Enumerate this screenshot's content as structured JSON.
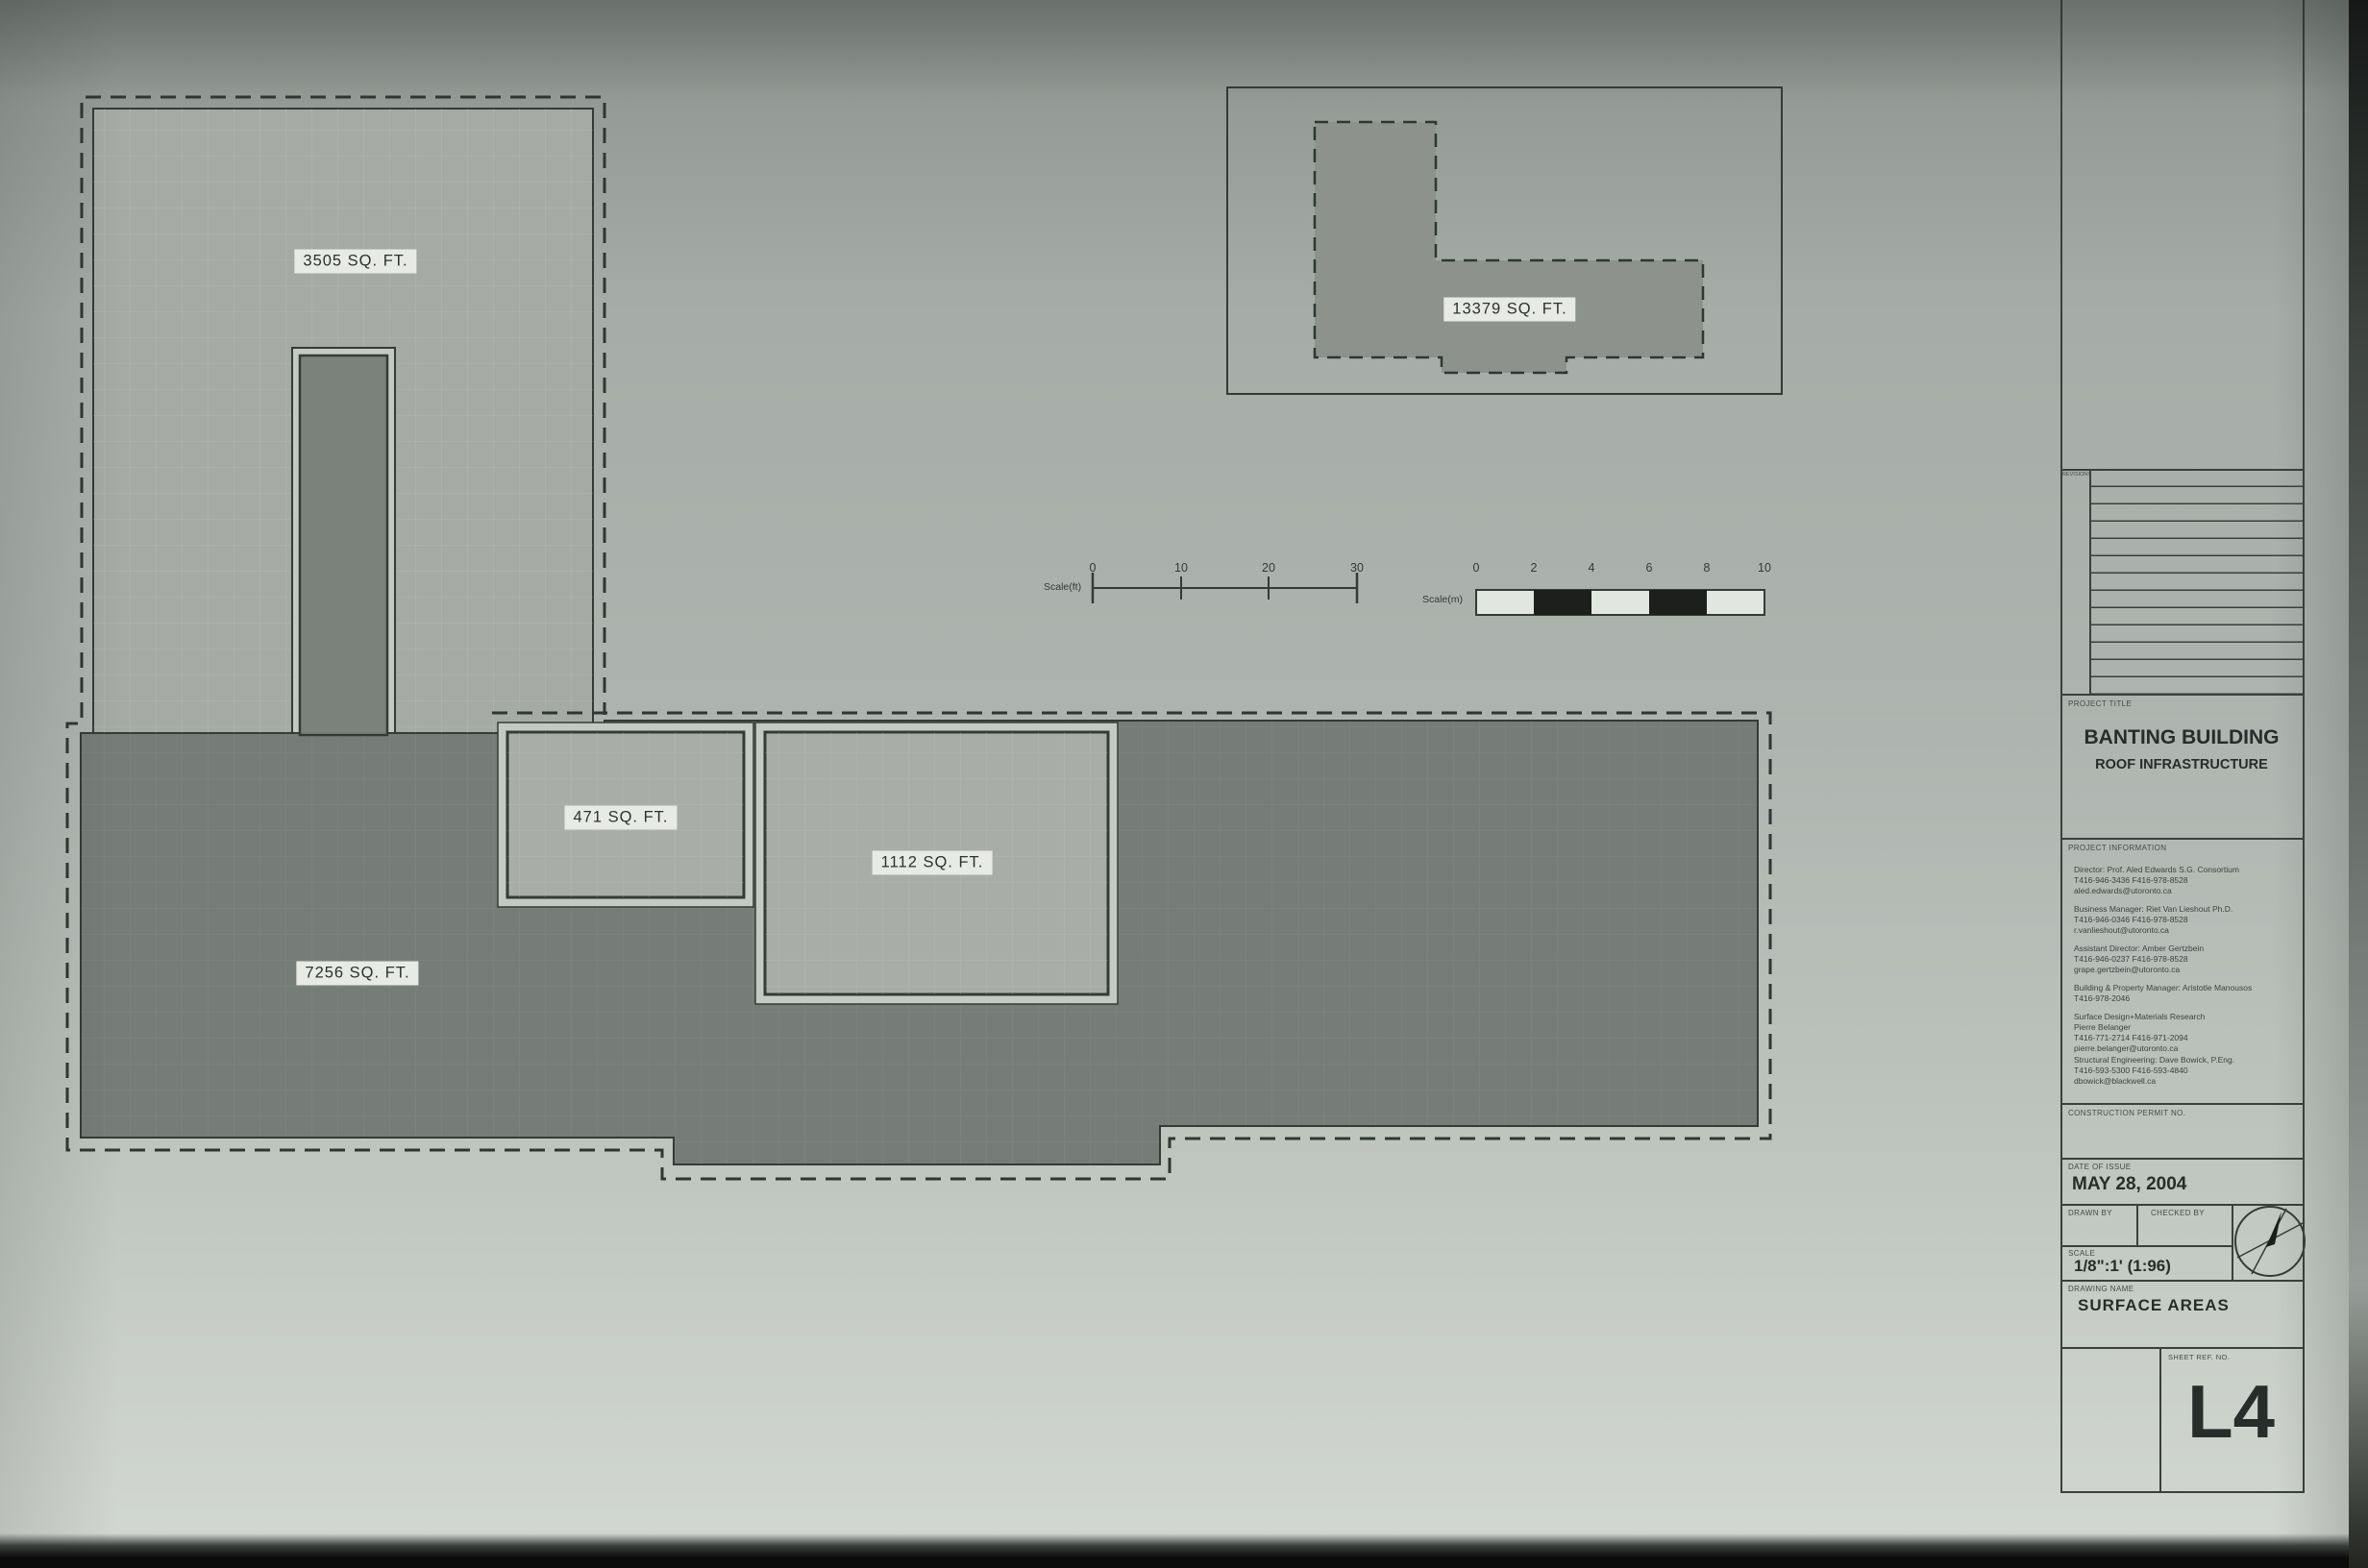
{
  "sheet": {
    "plan": {
      "areas": {
        "upper_left": "3505 SQ. FT.",
        "upper_right": "13379 SQ. FT.",
        "inset_small": "471 SQ. FT.",
        "inset_medium": "1112 SQ. FT.",
        "lower": "7256 SQ. FT."
      },
      "colors": {
        "line": "#343b37",
        "light_fill": "#a6aaa5",
        "dark_fill": "#767d78",
        "medium_fill": "#8d928d",
        "gap_fill": "#c5c9c4",
        "chip_bg": "#e7eae5"
      }
    },
    "scale_bar_ft": {
      "label": "Scale(ft)",
      "ticks": [
        "0",
        "10",
        "20",
        "30"
      ]
    },
    "scale_bar_m": {
      "label": "Scale(m)",
      "ticks": [
        "0",
        "2",
        "4",
        "6",
        "8",
        "10"
      ]
    },
    "title_block": {
      "revisions_label": "REVISIONS",
      "project_title_label": "PROJECT TITLE",
      "project_title": "BANTING BUILDING",
      "project_subtitle": "ROOF INFRASTRUCTURE",
      "project_information_label": "PROJECT INFORMATION",
      "contacts": [
        {
          "lines": [
            "Director: Prof. Aled Edwards S.G. Consortium",
            "T416-946-3436  F416-978-8528",
            "aled.edwards@utoronto.ca"
          ]
        },
        {
          "lines": [
            "Business Manager: Riet Van Lieshout Ph.D.",
            "T416-946-0346  F416-978-8528",
            "r.vanlieshout@utoronto.ca"
          ]
        },
        {
          "lines": [
            "Assistant Director: Amber Gertzbein",
            "T416-946-0237  F416-978-8528",
            "grape.gertzbein@utoronto.ca"
          ]
        },
        {
          "lines": [
            "Building & Property Manager: Aristotle Manousos",
            "T416-978-2046"
          ]
        },
        {
          "lines": [
            "Surface Design+Materials Research",
            "Pierre Belanger",
            "T416-771-2714  F416-971-2094",
            "pierre.belanger@utoronto.ca"
          ]
        },
        {
          "lines": [
            "Structural Engineering: Dave Bowick, P.Eng.",
            "T416-593-5300  F416-593-4840",
            "dbowick@blackwell.ca"
          ]
        }
      ],
      "construction_permit_label": "CONSTRUCTION PERMIT NO.",
      "date_of_issue_label": "DATE OF ISSUE",
      "date_of_issue": "MAY 28, 2004",
      "drawn_by_label": "DRAWN BY",
      "checked_by_label": "CHECKED BY",
      "scale_label": "SCALE",
      "scale_value": "1/8\":1' (1:96)",
      "drawing_name_label": "DRAWING NAME",
      "drawing_name": "SURFACE AREAS",
      "sheet_ref_label": "SHEET REF. NO.",
      "sheet_ref": "L4"
    }
  }
}
